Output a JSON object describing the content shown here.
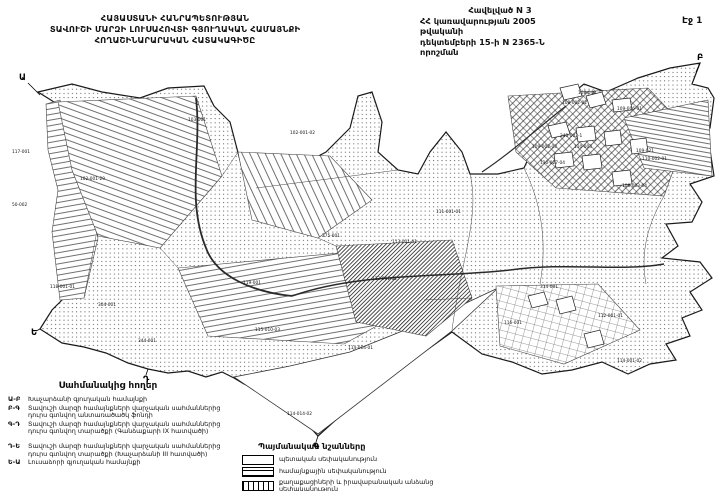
{
  "header": {
    "title_lines": [
      "ՀԱՅԱՍՏԱՆԻ ՀԱՆՐԱՊԵՏՈՒԹՅԱՆ",
      "ՏԱՎՈՒՇԻ ՄԱՐԶԻ ԼՈՒՍԱՀՈՎՏԻ ԳՅՈՒՂԱԿԱՆ ՀԱՄԱՅՆՔԻ",
      "ՀՈՂԱՇԻՆԱՐԱՐԱԿԱՆ ՀԱՏԱԿԱԳԻԾԸ"
    ],
    "annex_lines": [
      "Հավելված N 3",
      "ՀՀ կառավարության 2005 թվականի",
      "դեկտեմբերի 15-ի N 2365-Ն որոշման"
    ],
    "page_number": "Էջ 1"
  },
  "adjacent_lands": {
    "title": "Սահմանակից հողեր",
    "items": [
      {
        "code": "Ա-Բ",
        "text": "Խաչարձանի գյուղական համայնքի"
      },
      {
        "code": "Բ-Գ",
        "text": "Տավուշի մարզի համայնքների վարչական սահմաններից դուրս գտնվող անտառածածկ ֆոնդի"
      },
      {
        "code": "Գ-Դ",
        "text": "Տավուշի մարզի համայնքների վարչական սահմաններից դուրս գտնվող տարածքի (Գանձաքարի IX հատվածի)"
      },
      {
        "code": "Դ-Ե",
        "text": "Տավուշի մարզի համայնքների վարչական սահմաններից դուրս գտնվող տարածքի (Խաչարձանի III հատվածի)"
      },
      {
        "code": "Ե-Ա",
        "text": "Լուսաձորի գյուղական համայնքի"
      }
    ]
  },
  "map_legend": {
    "title": "Պայմանական նշանները",
    "items": [
      {
        "swatch": "state",
        "label": "պետական սեփականություն"
      },
      {
        "swatch": "community",
        "label": "համայնքային սեփականություն"
      },
      {
        "swatch": "private",
        "label": "քաղաքացիների և իրավաբանական անձանց սեփականություն"
      }
    ]
  },
  "map": {
    "ink_color": "#1a1a1a",
    "boundary_letters": [
      {
        "ch": "Ա",
        "x": 19,
        "y": 80,
        "lx1": 28,
        "ly1": 83,
        "lx2": 40,
        "ly2": 95
      },
      {
        "ch": "Բ",
        "x": 697,
        "y": 60,
        "lx1": 700,
        "ly1": 63,
        "lx2": 696,
        "ly2": 72
      },
      {
        "ch": "Գ",
        "x": 313,
        "y": 449,
        "lx1": 318,
        "ly1": 436,
        "lx2": 316,
        "ly2": 442
      },
      {
        "ch": "Դ",
        "x": 143,
        "y": 382,
        "lx1": 148,
        "ly1": 369,
        "lx2": 146,
        "ly2": 375
      },
      {
        "ch": "Ե",
        "x": 31,
        "y": 335,
        "lx1": 40,
        "ly1": 329,
        "lx2": 36,
        "ly2": 331
      }
    ],
    "parcel_labels": [
      {
        "t": "102-001-02",
        "x": 290,
        "y": 134
      },
      {
        "t": "103-001",
        "x": 188,
        "y": 121
      },
      {
        "t": "117-001",
        "x": 12,
        "y": 153
      },
      {
        "t": "102-001-29",
        "x": 80,
        "y": 180
      },
      {
        "t": "50-002",
        "x": 12,
        "y": 206
      },
      {
        "t": "118-001-01",
        "x": 50,
        "y": 288
      },
      {
        "t": "304-001",
        "x": 98,
        "y": 306
      },
      {
        "t": "344-001",
        "x": 138,
        "y": 342
      },
      {
        "t": "119-001",
        "x": 243,
        "y": 284
      },
      {
        "t": "275-001",
        "x": 322,
        "y": 237
      },
      {
        "t": "113-001-01",
        "x": 392,
        "y": 243
      },
      {
        "t": "113-001-02",
        "x": 372,
        "y": 280
      },
      {
        "t": "115-010-03",
        "x": 255,
        "y": 331
      },
      {
        "t": "114-014-01",
        "x": 348,
        "y": 349
      },
      {
        "t": "114-014-02",
        "x": 287,
        "y": 415
      },
      {
        "t": "108-040",
        "x": 578,
        "y": 94
      },
      {
        "t": "108-002-02",
        "x": 562,
        "y": 104
      },
      {
        "t": "109-006-01",
        "x": 617,
        "y": 110
      },
      {
        "t": "243-002-1",
        "x": 560,
        "y": 137
      },
      {
        "t": "109-002-03",
        "x": 532,
        "y": 148
      },
      {
        "t": "110-003",
        "x": 574,
        "y": 148
      },
      {
        "t": "110-027-04",
        "x": 540,
        "y": 164
      },
      {
        "t": "109-021",
        "x": 636,
        "y": 152
      },
      {
        "t": "110-002-01",
        "x": 642,
        "y": 160
      },
      {
        "t": "108-003-04",
        "x": 622,
        "y": 187
      },
      {
        "t": "111-001-01",
        "x": 436,
        "y": 213
      },
      {
        "t": "112-001-01",
        "x": 598,
        "y": 317
      },
      {
        "t": "314-001",
        "x": 540,
        "y": 288
      },
      {
        "t": "116-001",
        "x": 504,
        "y": 324
      },
      {
        "t": "114-001-02",
        "x": 617,
        "y": 362
      }
    ]
  }
}
